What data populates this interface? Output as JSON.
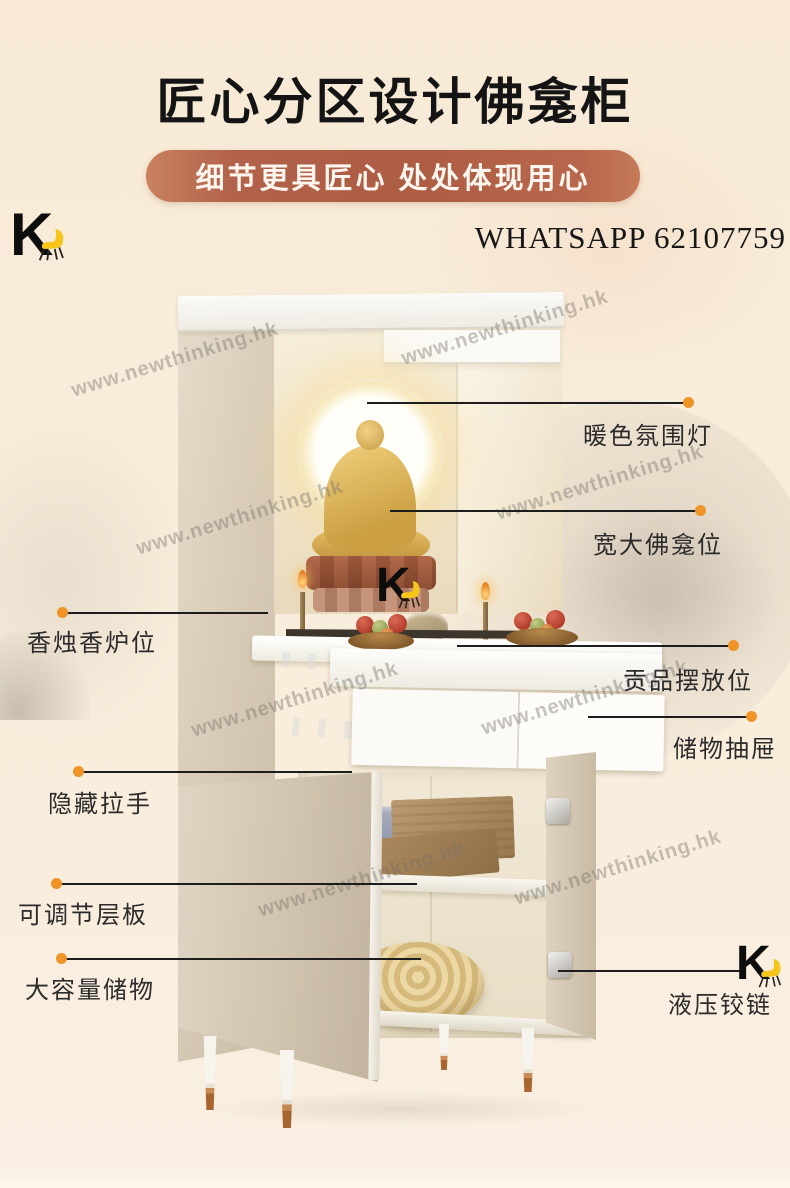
{
  "header": {
    "title": "匠心分区设计佛龛柜",
    "subtitle": "细节更具匠心 处处体现用心",
    "contact": "WHATSAPP 62107759"
  },
  "logo": {
    "letter": "K",
    "chair_color": "#f6c51c"
  },
  "watermark": {
    "text": "www.newthinking.hk"
  },
  "callouts": {
    "warm_light": "暖色氛围灯",
    "niche": "宽大佛龛位",
    "incense": "香烛香炉位",
    "offering": "贡品摆放位",
    "drawer": "储物抽屉",
    "handle": "隐藏拉手",
    "shelf": "可调节层板",
    "storage": "大容量储物",
    "hinge": "液压铰链"
  },
  "colors": {
    "background": "#f8ecda",
    "banner": "#b2614a",
    "accent_dot": "#ef9426",
    "logo_yellow": "#f6c51c"
  }
}
